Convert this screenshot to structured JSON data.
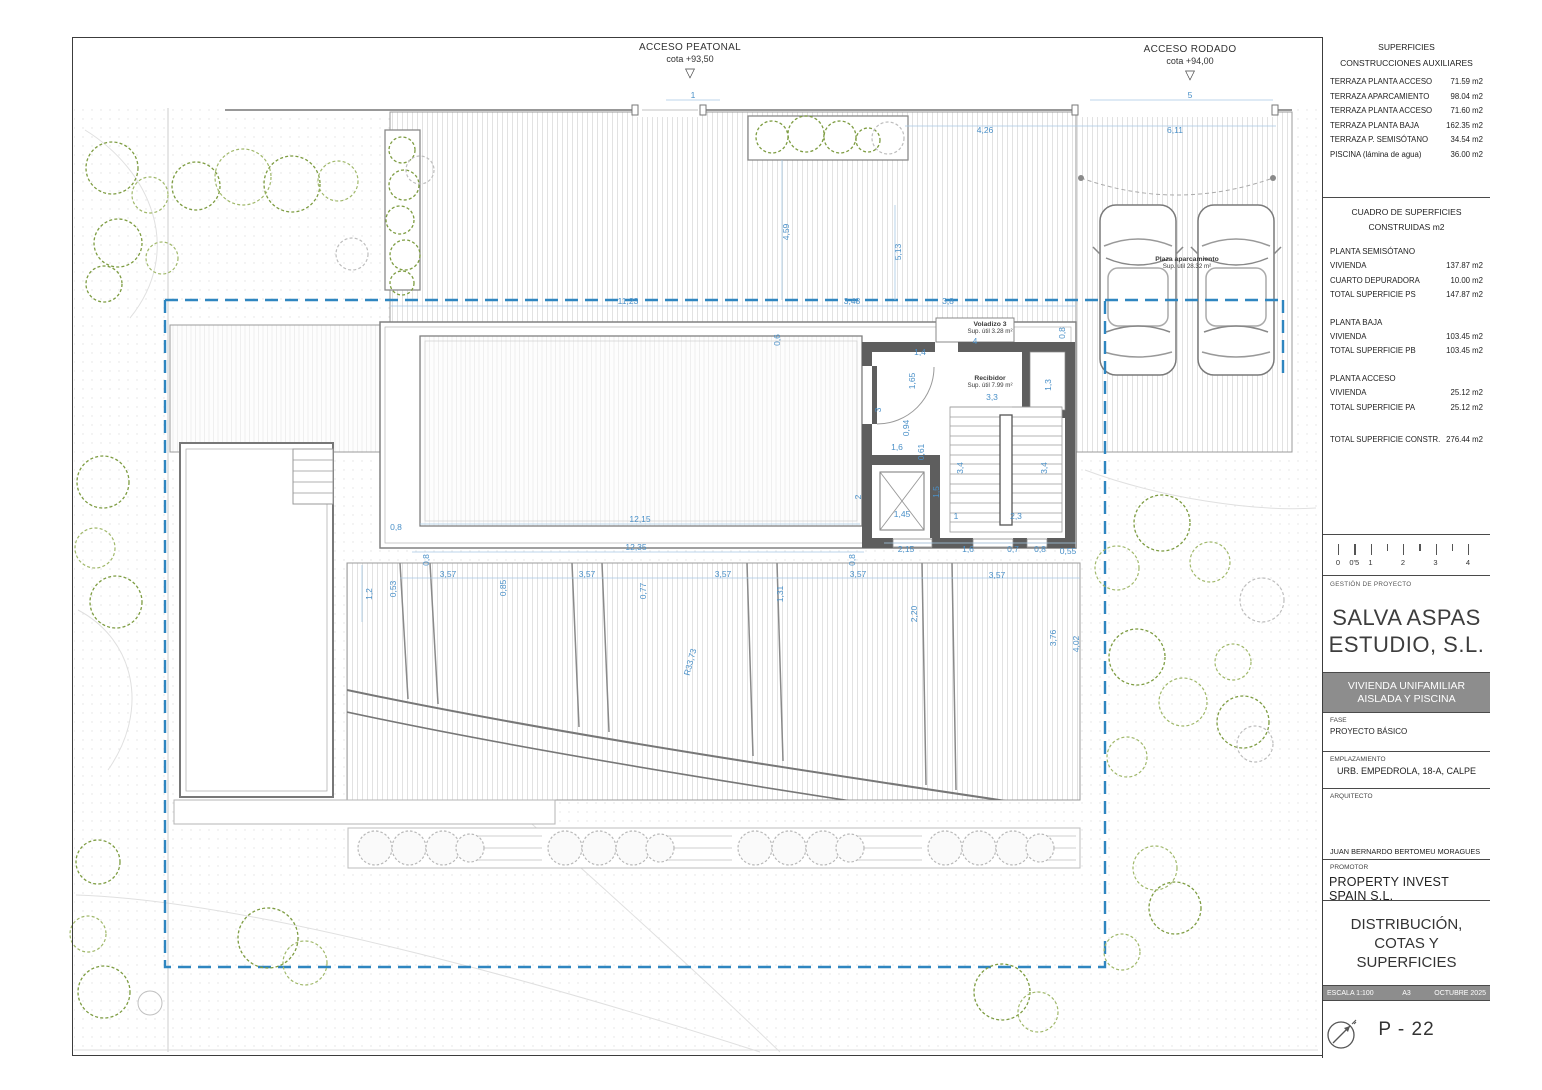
{
  "colors": {
    "dim_blue": "#4A90C8",
    "boundary_blue": "#2F86C0",
    "wall_gray": "#5E5E5E",
    "plant_green": "#7D9C41",
    "banner_gray": "#8D8D8D"
  },
  "access": {
    "peatonal": {
      "line1": "ACCESO PEATONAL",
      "line2": "cota +93,50",
      "triangle": "▽"
    },
    "rodado": {
      "line1": "ACCESO RODADO",
      "line2": "cota +94,00",
      "triangle": "▽"
    }
  },
  "panel": {
    "superficies": {
      "title": "SUPERFICIES",
      "subtitle": "CONSTRUCCIONES AUXILIARES",
      "rows": [
        {
          "label": "TERRAZA PLANTA ACCESO",
          "value": "71.59 m2"
        },
        {
          "label": "TERRAZA APARCAMIENTO",
          "value": "98.04 m2"
        },
        {
          "label": "TERRAZA PLANTA ACCESO",
          "value": "71.60 m2"
        },
        {
          "label": "TERRAZA PLANTA BAJA",
          "value": "162.35 m2"
        },
        {
          "label": "TERRAZA P. SEMISÓTANO",
          "value": "34.54 m2"
        },
        {
          "label": "PISCINA (lámina de agua)",
          "value": "36.00 m2"
        }
      ]
    },
    "cuadro": {
      "title1": "CUADRO DE SUPERFICIES",
      "title2": "CONSTRUIDAS m2",
      "sections": [
        {
          "heading": "PLANTA SEMISÓTANO",
          "rows": [
            {
              "label": "VIVIENDA",
              "value": "137.87 m2"
            },
            {
              "label": "CUARTO DEPURADORA",
              "value": "10.00 m2"
            },
            {
              "label": "TOTAL SUPERFICIE PS",
              "value": "147.87 m2"
            }
          ]
        },
        {
          "heading": "PLANTA BAJA",
          "rows": [
            {
              "label": "VIVIENDA",
              "value": "103.45 m2"
            },
            {
              "label": "TOTAL SUPERFICIE PB",
              "value": "103.45 m2"
            }
          ]
        },
        {
          "heading": "PLANTA ACCESO",
          "rows": [
            {
              "label": "VIVIENDA",
              "value": "25.12 m2"
            },
            {
              "label": "TOTAL SUPERFICIE PA",
              "value": "25.12 m2"
            }
          ]
        }
      ],
      "total": {
        "label": "TOTAL SUPERFICIE CONSTR.",
        "value": "276.44 m2"
      }
    },
    "scalebar": {
      "ticks": [
        {
          "label": "0",
          "v": 0
        },
        {
          "label": "0'5",
          "v": 0.5
        },
        {
          "label": "1",
          "v": 1
        },
        {
          "label": "",
          "v": 1.5
        },
        {
          "label": "2",
          "v": 2
        },
        {
          "label": "",
          "v": 2.5
        },
        {
          "label": "3",
          "v": 3
        },
        {
          "label": "",
          "v": 3.5
        },
        {
          "label": "4",
          "v": 4
        }
      ]
    },
    "gestion": {
      "label": "GESTIÓN DE PROYECTO",
      "company1": "SALVA ASPAS",
      "company2": "ESTUDIO, S.L."
    },
    "banner": {
      "line1": "VIVIENDA UNIFAMILIAR",
      "line2": "AISLADA Y PISCINA"
    },
    "fase": {
      "label": "FASE",
      "value": "PROYECTO BÁSICO"
    },
    "emplazamiento": {
      "label": "EMPLAZAMIENTO",
      "value": "URB. EMPEDROLA, 18-A, CALPE"
    },
    "arquitecto": {
      "label": "ARQUITECTO",
      "value": "JUAN BERNARDO BERTOMEU MORAGUES"
    },
    "promotor": {
      "label": "PROMOTOR",
      "value": "PROPERTY INVEST SPAIN S.L."
    },
    "drawing_title": {
      "line1": "DISTRIBUCIÓN,",
      "line2": "COTAS Y SUPERFICIES",
      "line3": "PLANTA ACCESO"
    },
    "meta": {
      "escala": "ESCALA 1:100",
      "formato": "A3",
      "fecha": "OCTUBRE 2025"
    },
    "sheet_number": "P - 22"
  },
  "plan": {
    "room_labels": [
      {
        "name": "Voladizo 3",
        "area": "Sup. útil 3.28 m²",
        "x": 990,
        "y": 321
      },
      {
        "name": "Recibidor",
        "area": "Sup. útil 7.99 m²",
        "x": 990,
        "y": 375
      },
      {
        "name": "Plaza aparcamiento",
        "area": "Sup. útil 28.32 m²",
        "x": 1187,
        "y": 256
      }
    ],
    "dimensions": [
      {
        "t": "1",
        "x": 693,
        "y": 95
      },
      {
        "t": "5",
        "x": 1190,
        "y": 95
      },
      {
        "t": "4,26",
        "x": 985,
        "y": 130
      },
      {
        "t": "6,11",
        "x": 1175,
        "y": 130
      },
      {
        "t": "4,59",
        "x": 786,
        "y": 232,
        "r": -90
      },
      {
        "t": "5,13",
        "x": 898,
        "y": 252,
        "r": -90
      },
      {
        "t": "11,23",
        "x": 628,
        "y": 301
      },
      {
        "t": "3,48",
        "x": 852,
        "y": 301
      },
      {
        "t": "3,8",
        "x": 948,
        "y": 301
      },
      {
        "t": "0,6",
        "x": 777,
        "y": 340,
        "r": -90
      },
      {
        "t": "0,8",
        "x": 1062,
        "y": 333,
        "r": -90
      },
      {
        "t": "4",
        "x": 975,
        "y": 341
      },
      {
        "t": "1,4",
        "x": 920,
        "y": 352
      },
      {
        "t": "1,65",
        "x": 912,
        "y": 381,
        "r": -90
      },
      {
        "t": "3",
        "x": 878,
        "y": 410,
        "r": -90
      },
      {
        "t": "0,94",
        "x": 906,
        "y": 428,
        "r": -90
      },
      {
        "t": "1,6",
        "x": 897,
        "y": 447
      },
      {
        "t": "0,61",
        "x": 921,
        "y": 452,
        "r": -90
      },
      {
        "t": "1,3",
        "x": 1048,
        "y": 385,
        "r": -90
      },
      {
        "t": "3,3",
        "x": 992,
        "y": 397
      },
      {
        "t": "3,4",
        "x": 960,
        "y": 468,
        "r": -90
      },
      {
        "t": "3,4",
        "x": 1044,
        "y": 468,
        "r": -90
      },
      {
        "t": "2",
        "x": 858,
        "y": 497,
        "r": -90
      },
      {
        "t": "1,45",
        "x": 902,
        "y": 514
      },
      {
        "t": "1,5",
        "x": 936,
        "y": 492,
        "r": -90
      },
      {
        "t": "1",
        "x": 956,
        "y": 516
      },
      {
        "t": "2,3",
        "x": 1016,
        "y": 516
      },
      {
        "t": "12,15",
        "x": 640,
        "y": 519
      },
      {
        "t": "0,8",
        "x": 396,
        "y": 527
      },
      {
        "t": "12,35",
        "x": 636,
        "y": 547
      },
      {
        "t": "0,8",
        "x": 426,
        "y": 560,
        "r": -90
      },
      {
        "t": "0,8",
        "x": 852,
        "y": 560,
        "r": -90
      },
      {
        "t": "2,15",
        "x": 906,
        "y": 549
      },
      {
        "t": "1,6",
        "x": 968,
        "y": 549
      },
      {
        "t": "0,7",
        "x": 1013,
        "y": 549
      },
      {
        "t": "0,8",
        "x": 1040,
        "y": 549
      },
      {
        "t": "0,55",
        "x": 1068,
        "y": 551
      },
      {
        "t": "1,2",
        "x": 369,
        "y": 594,
        "r": -90
      },
      {
        "t": "0,53",
        "x": 393,
        "y": 589,
        "r": -90
      },
      {
        "t": "3,57",
        "x": 448,
        "y": 574
      },
      {
        "t": "0,85",
        "x": 503,
        "y": 588,
        "r": -90
      },
      {
        "t": "3,57",
        "x": 587,
        "y": 574
      },
      {
        "t": "0,77",
        "x": 643,
        "y": 591,
        "r": -90
      },
      {
        "t": "3,57",
        "x": 723,
        "y": 574
      },
      {
        "t": "1,31",
        "x": 780,
        "y": 594,
        "r": -90
      },
      {
        "t": "3,57",
        "x": 858,
        "y": 574
      },
      {
        "t": "2,20",
        "x": 914,
        "y": 614,
        "r": -90
      },
      {
        "t": "3,57",
        "x": 997,
        "y": 575
      },
      {
        "t": "3,76",
        "x": 1053,
        "y": 638,
        "r": -90
      },
      {
        "t": "4,02",
        "x": 1076,
        "y": 644,
        "r": -90
      },
      {
        "t": "R33,73",
        "x": 690,
        "y": 662,
        "r": -75
      }
    ]
  }
}
